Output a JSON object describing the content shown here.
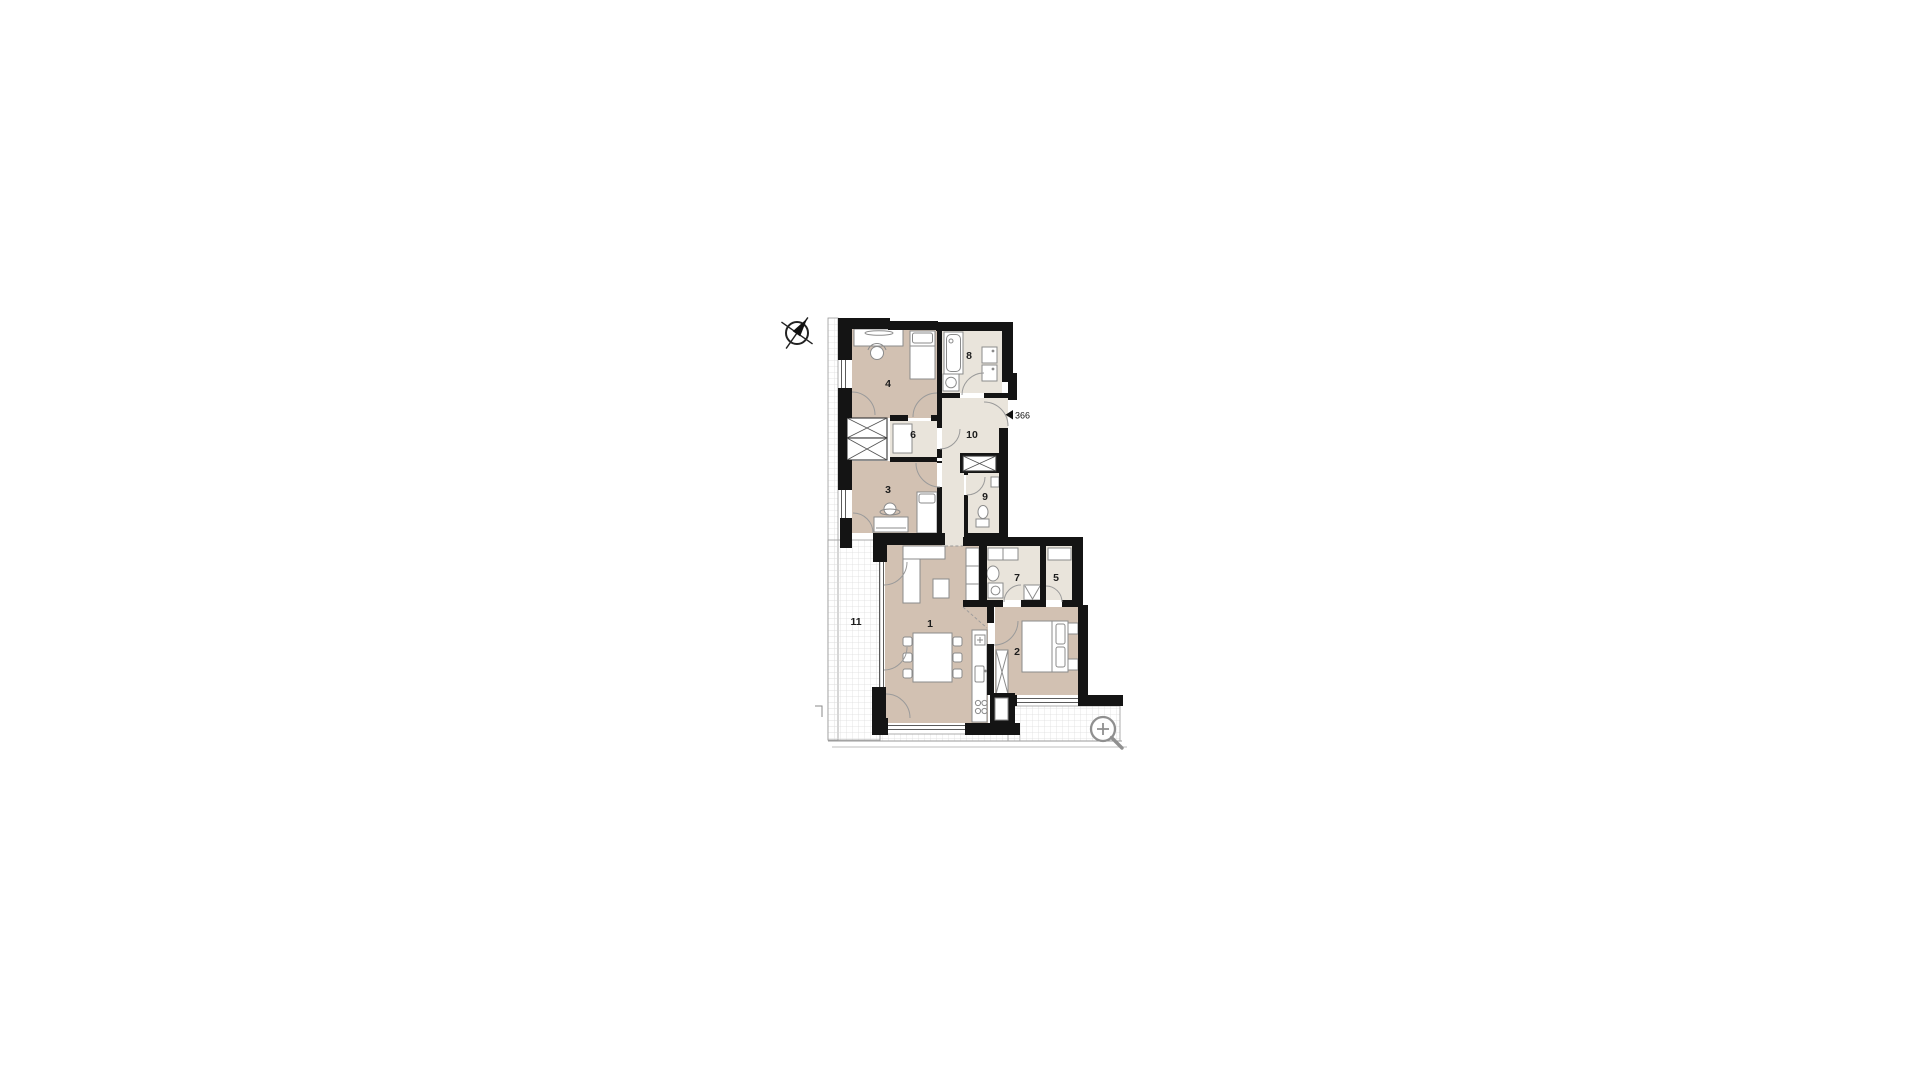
{
  "floor_plan": {
    "room_labels": {
      "r1": "1",
      "r2": "2",
      "r3": "3",
      "r4": "4",
      "r5": "5",
      "r6": "6",
      "r7": "7",
      "r8": "8",
      "r9": "9",
      "r10": "10",
      "r11": "11"
    },
    "door_marker": "366",
    "colors": {
      "wall": "#141414",
      "room_dark_floor": "#d2c1b2",
      "room_light_floor": "#e9e4db",
      "terrace_grid_line": "#dcdcdc",
      "outline_gray": "#8f8f8f"
    },
    "icons": {
      "compass": "compass-rose-icon",
      "magnifier": "zoom-in-icon"
    }
  }
}
